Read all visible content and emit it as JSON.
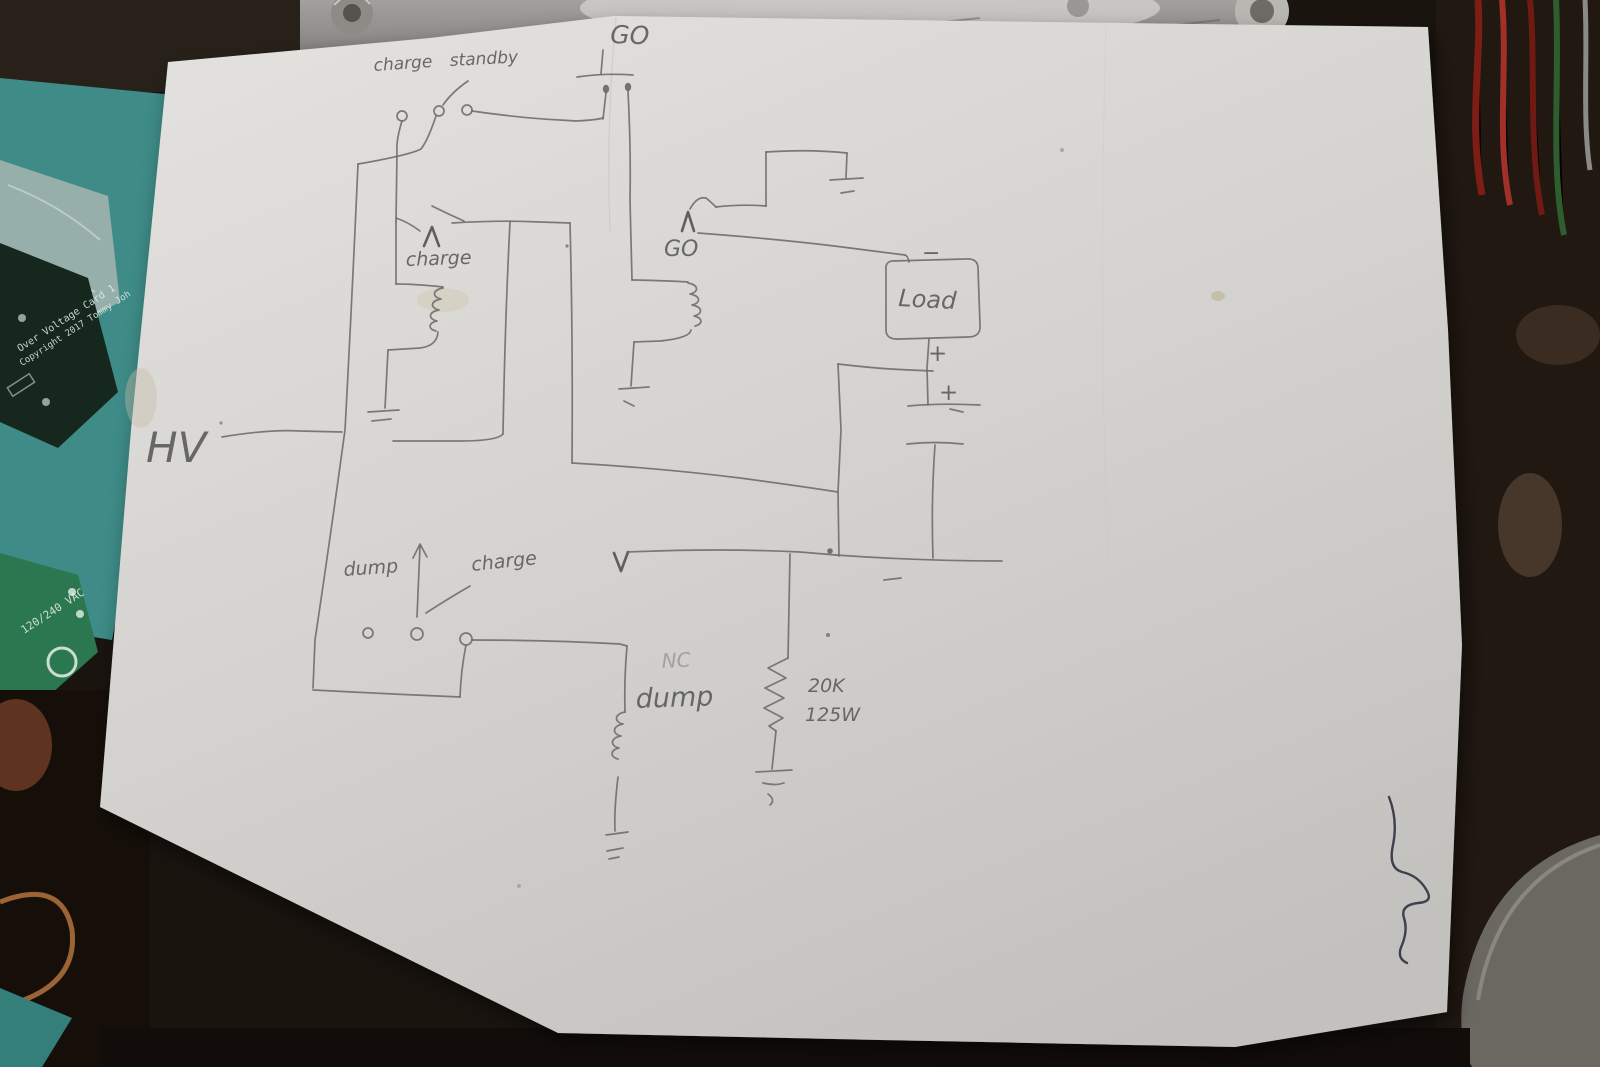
{
  "photo": {
    "paper_color": "#d5d3cf",
    "pencil_color": "#6b6b6b",
    "ink_color": "#2f3340",
    "bench_teal": "#3e8b87",
    "metal_gray": "#8f8d89"
  },
  "schematic": {
    "hv": "HV",
    "top_switch": {
      "left_label": "charge",
      "right_label": "standby"
    },
    "go_button": "GO",
    "charge_relay": "charge",
    "go_relay": "GO",
    "load": "Load",
    "polarity": {
      "minus": "−",
      "plus_upper": "+",
      "plus_lower": "+"
    },
    "dump_switch": {
      "left_label": "dump",
      "right_label": "charge"
    },
    "dump_relay": {
      "contact": "NC",
      "label": "dump"
    },
    "bleeder_resistor": {
      "resistance": "20K",
      "power": "125W"
    }
  },
  "bench_items": {
    "overvoltage_pcb": {
      "line1": "Over Voltage Card 1",
      "line2": "Copyright 2017 Tommy Joh"
    },
    "power_pcb": {
      "label": "120/240 VAC"
    }
  }
}
